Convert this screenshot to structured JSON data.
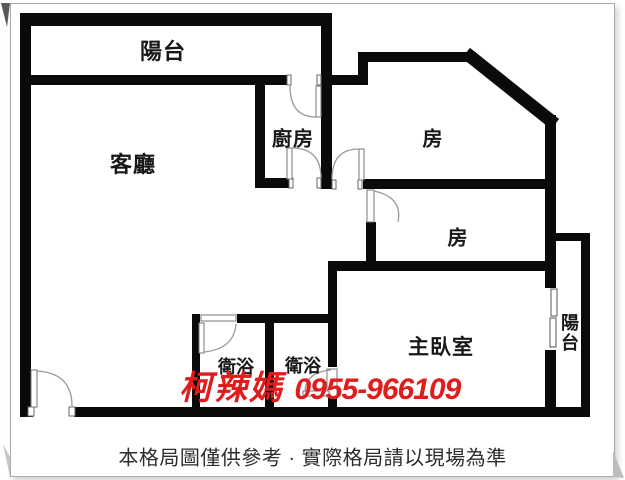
{
  "floorplan": {
    "rooms": {
      "balcony_top": "陽台",
      "living_room": "客廳",
      "kitchen": "廚房",
      "room_1": "房",
      "room_2": "房",
      "master_bedroom": "主臥室",
      "bathroom_1": "衛浴",
      "bathroom_2": "衛浴",
      "balcony_right": "陽台"
    },
    "watermark": {
      "agent_name": "柯辣媽",
      "phone": "0955-966109",
      "color": "#e01c1c"
    },
    "disclaimer": "本格局圖僅供參考 · 實際格局請以現場為準",
    "colors": {
      "wall": "#0a0a0a",
      "background": "#ffffff",
      "frame_border": "#aaaaaa"
    }
  }
}
